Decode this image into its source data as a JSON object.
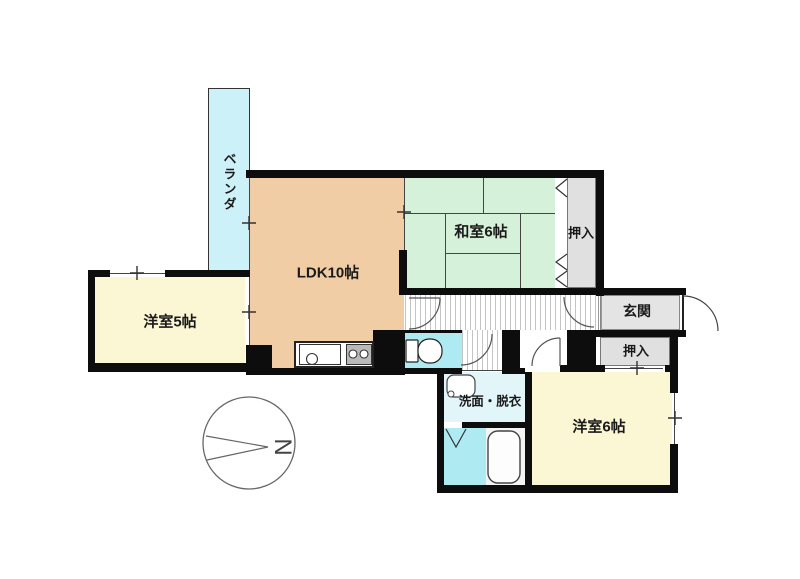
{
  "diagram_type": "apartment-floor-plan",
  "rooms": {
    "veranda": {
      "label": "ベランダ"
    },
    "ldk": {
      "label": "LDK10帖"
    },
    "japanese_room": {
      "label": "和室6帖"
    },
    "closet_top": {
      "label": "押入"
    },
    "entrance": {
      "label": "玄関"
    },
    "closet_right": {
      "label": "押入"
    },
    "western_room_5": {
      "label": "洋室5帖"
    },
    "western_room_6": {
      "label": "洋室6帖"
    },
    "washroom": {
      "label": "洗面・脱衣"
    }
  },
  "compass": {
    "north_label": "N"
  },
  "colors": {
    "wall": "#0d0d0d",
    "veranda": "#cdf1f8",
    "ldk": "#f0cda5",
    "tatami": "#d6f1da",
    "western-room": "#fbf6d3",
    "closet": "#e0e0e0",
    "entrance": "#e4e4e4",
    "water-cyan": "#aeeaf2",
    "washroom": "#e2f5f8",
    "line": "#444444"
  }
}
